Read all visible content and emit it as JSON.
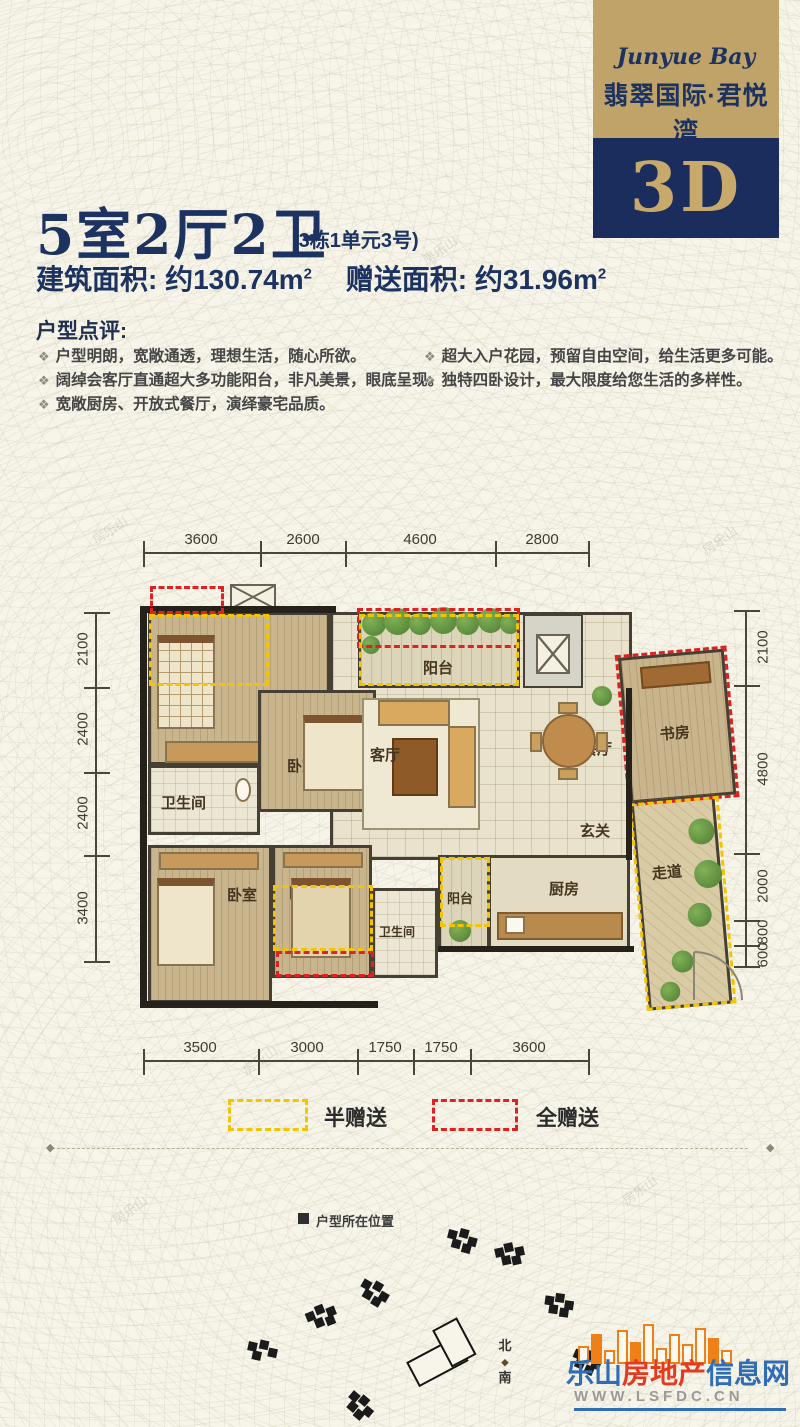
{
  "banner": {
    "script_name": "Junyue Bay",
    "brand_name": "翡翠国际·君悦湾",
    "badge": "3D"
  },
  "header": {
    "title": "5室2厅2卫",
    "unit_note": "(3栋1单元3号)",
    "build_area_label": "建筑面积:",
    "build_area_value": "约130.74m",
    "build_area_sup": "2",
    "gift_area_label": "赠送面积:",
    "gift_area_value": "约31.96m",
    "gift_area_sup": "2"
  },
  "review": {
    "heading": "户型点评:",
    "bullet_glyph": "❖",
    "left_items": [
      "户型明朗，宽敞通透，理想生活，随心所欲。",
      "阔绰会客厅直通超大多功能阳台，非凡美景，眼底呈现。",
      "宽敞厨房、开放式餐厅，演绎豪宅品质。"
    ],
    "right_items": [
      "超大入户花园，预留自由空间，给生活更多可能。",
      "独特四卧设计，最大限度给您生活的多样性。"
    ]
  },
  "plan": {
    "dims_top": [
      "3600",
      "2600",
      "4600",
      "2800"
    ],
    "dims_bottom": [
      "3500",
      "3000",
      "1750",
      "1750",
      "3600"
    ],
    "dims_left": [
      "2100",
      "2400",
      "2400",
      "3400"
    ],
    "dims_right": [
      "2100",
      "4800",
      "2000",
      "800",
      "600"
    ],
    "rooms": {
      "bedroom_top_left": "卧室",
      "bedroom_top_mid": "卧室",
      "bath_upper": "卫生间",
      "balcony_top": "阳台",
      "living": "客厅",
      "dining": "餐厅",
      "study": "书房",
      "foyer": "玄关",
      "bedroom_bottom_left": "卧室",
      "bedroom_bottom_mid": "卧室",
      "bath_lower": "卫生间",
      "balcony_small": "阳台",
      "kitchen": "厨房",
      "corridor": "走道"
    }
  },
  "legend": {
    "half_label": "半赠送",
    "full_label": "全赠送",
    "half_color": "#f2c500",
    "full_color": "#e02121"
  },
  "siteplan": {
    "location_label": "户型所在位置",
    "north_label": "北",
    "south_label": "南"
  },
  "logo": {
    "city": "乐山",
    "middle": "房地产",
    "suffix": "信息网",
    "url": "WWW.LSFDC.CN"
  },
  "watermark": {
    "text": "房乐山"
  },
  "colors": {
    "navy": "#1c3260",
    "gold": "#bfa369",
    "cream": "#f7f4ea",
    "wall": "#464034",
    "half_gift": "#f2c500",
    "full_gift": "#e02121"
  }
}
